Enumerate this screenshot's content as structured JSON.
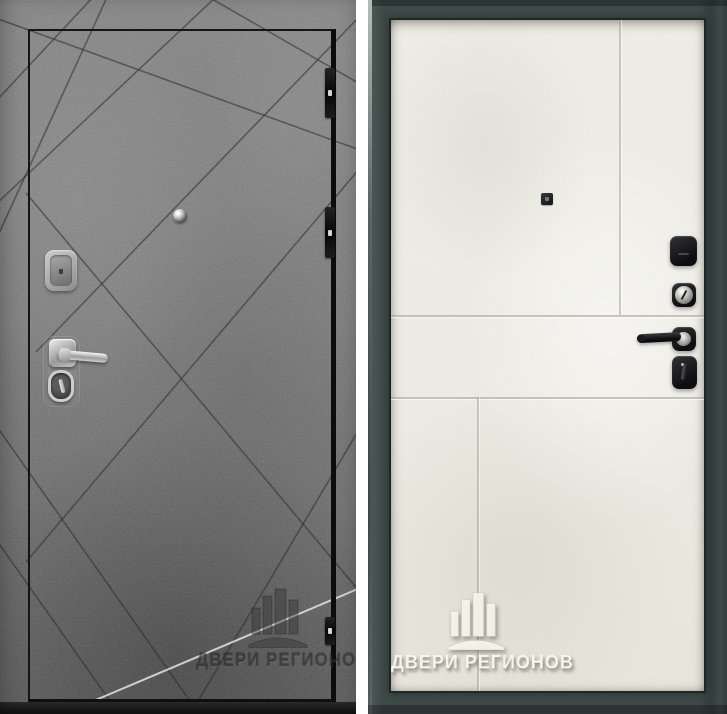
{
  "meta": {
    "description": "Product photograph of a steel entry door shown from both sides: exterior gray concrete-texture leaf with diagonal ray grooves, and interior light cream flat panel in a dark slate frame"
  },
  "brand": {
    "watermark_text": "ДВЕРИ РЕГИОНОВ",
    "logo": "building-columns-logo"
  },
  "left_view": {
    "name": "exterior-concrete-side",
    "watermark_text": "ДВЕРИ РЕГИОНОВ",
    "surface_color": "#7d7d7d",
    "groove_color": "#3a3a3a",
    "leaf_outline_color": "#121212",
    "hinge_count": 3,
    "hardware": [
      "peephole",
      "cylinder-guard",
      "lever-handle",
      "keyhole"
    ]
  },
  "right_view": {
    "name": "interior-panel-side",
    "watermark_text": "ДВЕРИ РЕГИОНОВ",
    "panel_color": "#eceae2",
    "frame_color": "#3e4a48",
    "hardware_color": "#141416",
    "hardware": [
      "peephole",
      "lock-cover",
      "key-cylinder",
      "lever-handle",
      "thumbturn"
    ]
  }
}
